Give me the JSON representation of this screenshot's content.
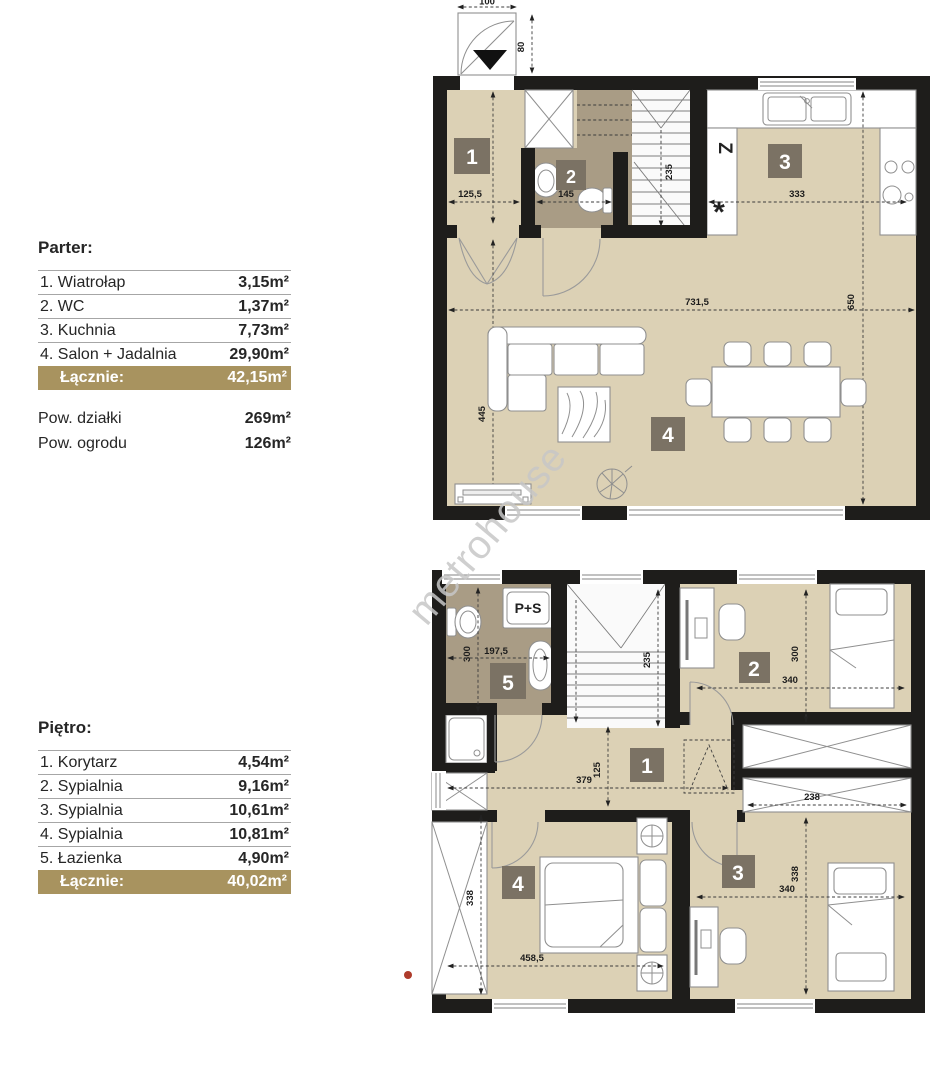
{
  "watermark": "metrohouse",
  "colors": {
    "wall": "#1e1d1b",
    "floor_beige": "#dcd1b5",
    "room_brown": "#a99c85",
    "badge": "#7b7264",
    "legend_highlight": "#a8935f"
  },
  "legend_parter": {
    "title": "Parter:",
    "rows": [
      {
        "name": "1. Wiatrołap",
        "area": "3,15m²"
      },
      {
        "name": "2. WC",
        "area": "1,37m²"
      },
      {
        "name": "3. Kuchnia",
        "area": "7,73m²"
      },
      {
        "name": "4. Salon + Jadalnia",
        "area": "29,90m²"
      }
    ],
    "total_label": "Łącznie:",
    "total_area": "42,15m²",
    "extra_rows": [
      {
        "name": "Pow. działki",
        "area": "269m²"
      },
      {
        "name": "Pow. ogrodu",
        "area": "126m²"
      }
    ]
  },
  "legend_pietro": {
    "title": "Piętro:",
    "rows": [
      {
        "name": "1. Korytarz",
        "area": "4,54m²"
      },
      {
        "name": "2. Sypialnia",
        "area": "9,16m²"
      },
      {
        "name": "3. Sypialnia",
        "area": "10,61m²"
      },
      {
        "name": "4. Sypialnia",
        "area": "10,81m²"
      },
      {
        "name": "5. Łazienka",
        "area": "4,90m²"
      }
    ],
    "total_label": "Łącznie:",
    "total_area": "40,02m²"
  },
  "ground_plan": {
    "badges": [
      "1",
      "2",
      "3",
      "4"
    ],
    "entrance": {
      "width": "100",
      "height": "80"
    },
    "symbols": {
      "fridge": "Z",
      "star": "*"
    },
    "dims": {
      "d216": "216",
      "d1255": "125,5",
      "d145": "145",
      "d235": "235",
      "d333": "333",
      "d650": "650",
      "d7315": "731,5",
      "d445": "445"
    }
  },
  "upper_plan": {
    "badges": [
      "1",
      "2",
      "3",
      "4",
      "5"
    ],
    "washer_label": "P+S",
    "dims": {
      "d300bath": "300",
      "d1975": "197,5",
      "d235": "235",
      "d300b2": "300",
      "d340b2": "340",
      "d379": "379",
      "d125": "125",
      "d238": "238",
      "d338b3": "338",
      "d340b3": "340",
      "d338b4": "338",
      "d4585": "458,5"
    }
  }
}
